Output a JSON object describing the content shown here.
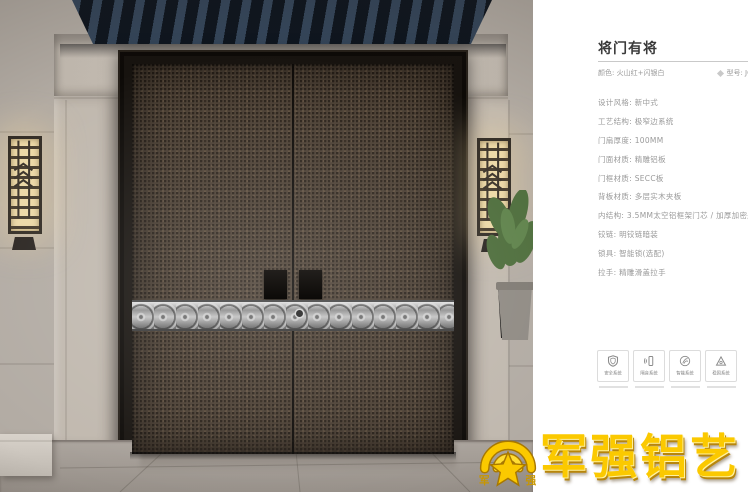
{
  "panel": {
    "title": "将门有将",
    "color_label": "颜色: 火山红+闪银白",
    "model_label": "型号: JC",
    "specs": [
      "设计风格: 新中式",
      "工艺结构: 极窄边系统",
      "门扇厚度: 100MM",
      "门面材质: 精雕铝板",
      "门框材质: SECC板",
      "背板材质: 多层实木夹板",
      "内结构: 3.5MM太空铝框架门芯 / 加厚加密航空铝蜂窝芯",
      "铰链: 明铰链暗装",
      "锁具: 智能锁(选配)",
      "拉手: 精雕滑盖拉手"
    ],
    "features": [
      {
        "icon": "shield-icon",
        "label": "安全系统"
      },
      {
        "icon": "sound-insulation-icon",
        "label": "隔音系统"
      },
      {
        "icon": "fingerprint-icon",
        "label": "智能系统"
      },
      {
        "icon": "triangle-stability-icon",
        "label": "稳固系统"
      }
    ]
  },
  "logo": {
    "brand": "军强铝艺",
    "emblem_left": "军",
    "emblem_right": "强"
  },
  "colors": {
    "brand_gold": "#fbc900",
    "door_leaf": "#4a3e32",
    "band_silver": "#bdbdbd",
    "roof_navy": "#1a2430",
    "wall_stone": "#b2aba3"
  }
}
